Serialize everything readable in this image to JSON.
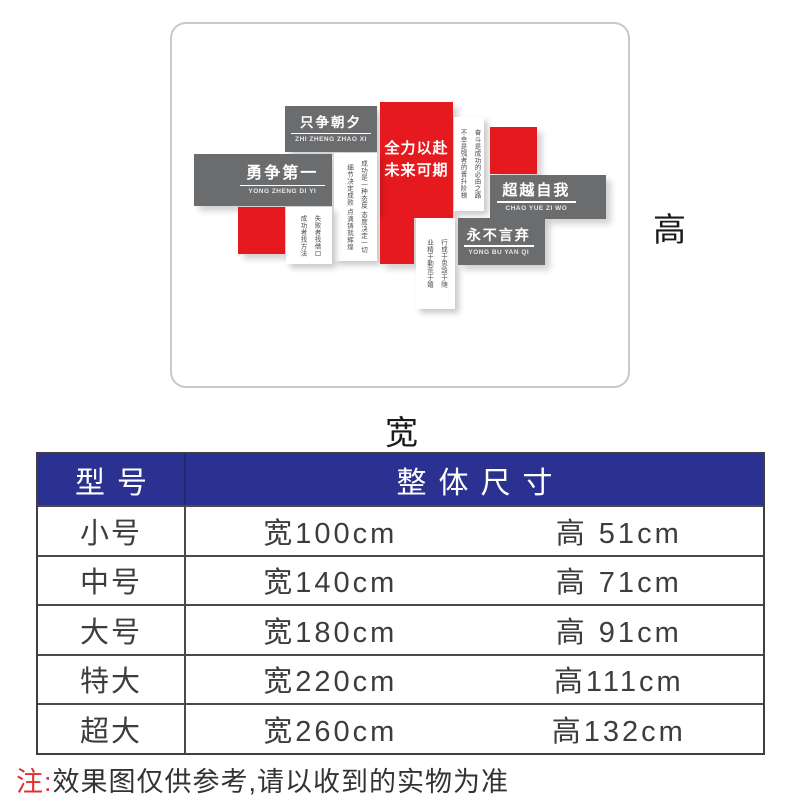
{
  "preview": {
    "height_label": "高",
    "width_label": "宽",
    "blocks": {
      "zhi_zheng_zhao_xi": {
        "title": "只争朝夕",
        "pinyin": "ZHI ZHENG ZHAO XI"
      },
      "quan_li_yi_fu": {
        "line1": "全力以赴",
        "line2": "未来可期"
      },
      "yong_zheng_di_yi": {
        "title": "勇争第一",
        "pinyin": "YONG ZHENG DI YI"
      },
      "chao_yue_zi_wo": {
        "title": "超越自我",
        "pinyin": "CHAO YUE ZI WO"
      },
      "yong_bu_yan_qi": {
        "title": "永不言弃",
        "pinyin": "YONG BU YAN QI"
      },
      "strip_fendou": {
        "col1": "奋斗是成功的必由之路",
        "col2": "不幸是强者的晋升阶梯"
      },
      "strip_chenggong": {
        "col1": "成功是一种态度 态度决定一切",
        "col2": "细节决定成败 点滴铸就辉煌"
      },
      "strip_shibai": {
        "col1": "失败者找借口",
        "col2": "成功者找方法"
      },
      "strip_xingcheng": {
        "col1": "行成于思毁于随",
        "col2": "业精于勤荒于嬉"
      }
    },
    "colors": {
      "red": "#e6191e",
      "gray": "#6b6c6e"
    }
  },
  "size_table": {
    "header_bg": "#2b3190",
    "headers": [
      "型号",
      "整体尺寸"
    ],
    "rows": [
      {
        "model": "小号",
        "width": "宽100cm",
        "height": "高 51cm"
      },
      {
        "model": "中号",
        "width": "宽140cm",
        "height": "高 71cm"
      },
      {
        "model": "大号",
        "width": "宽180cm",
        "height": "高 91cm"
      },
      {
        "model": "特大",
        "width": "宽220cm",
        "height": "高111cm"
      },
      {
        "model": "超大",
        "width": "宽260cm",
        "height": "高132cm"
      }
    ]
  },
  "note": {
    "prefix": "注:",
    "text": "效果图仅供参考,请以收到的实物为准"
  }
}
